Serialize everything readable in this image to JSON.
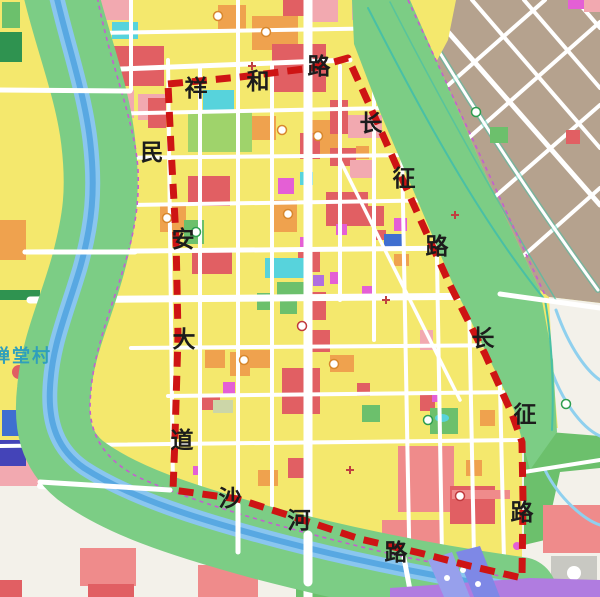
{
  "map": {
    "type": "urban planning zoning map",
    "village_label": "禅堂村",
    "roads": {
      "xianghe": {
        "name": "祥和路",
        "chars": [
          "祥",
          "和",
          "路"
        ]
      },
      "minan": {
        "name": "民安大道",
        "chars": [
          "民",
          "安",
          "大",
          "道"
        ]
      },
      "changzheng_upper": {
        "name": "长征路",
        "chars": [
          "长",
          "征",
          "路"
        ]
      },
      "changzheng_lower": {
        "name": "长征路",
        "chars": [
          "长",
          "征",
          "路"
        ]
      },
      "shahe": {
        "name": "沙河路",
        "chars": [
          "沙",
          "河",
          "路"
        ]
      }
    },
    "boundary": {
      "description": "red dashed planning boundary enclosed by 祥和路 (north), 长征路 (east), 沙河路 (south), 民安大道 (west)",
      "color": "#ce1414",
      "style": "dashed"
    },
    "palette": {
      "yellow": "#f4e86d",
      "red": "#e15f63",
      "salmon": "#ef8b8b",
      "pink": "#f2a9b0",
      "orange": "#efa24e",
      "magenta": "#e45fd5",
      "purple": "#b06fe0",
      "cyan": "#57d3dc",
      "ltgreen": "#9fd36b",
      "green": "#6cc06c",
      "dkgreen": "#2f9350",
      "corridor": "#7ccd85",
      "river": "#8ac6ef",
      "rivercore": "#58a8e2",
      "tan": "#b5a28e",
      "whitearea": "#f3f1ea",
      "road": "#ffffff",
      "stream": "#49c0a5",
      "streamblue": "#8fd0ee",
      "boundary": "#ce1414",
      "purpledash": "#c45fd0",
      "blueblock": "#3f6fd0",
      "indigo": "#4444b8",
      "peri1": "#97a0ec",
      "peri2": "#7e88e6",
      "violet": "#b07ce0",
      "grayblock": "#c8c8c2",
      "sage": "#ccd6a8",
      "labelcolor": "#1c1c1c",
      "villagecolor": "#2f9fbc"
    }
  }
}
